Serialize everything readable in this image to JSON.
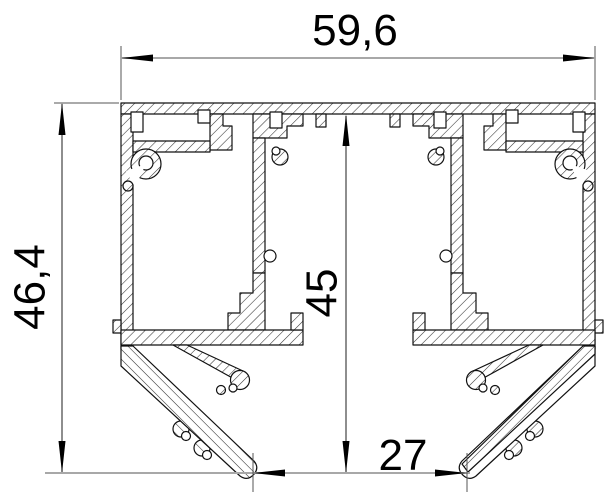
{
  "drawing": {
    "kind": "aluminium-profile-cross-section",
    "units_decimal_separator": ","
  },
  "dimensions": {
    "overall_width": {
      "label": "59,6",
      "orientation": "horizontal",
      "position": "top"
    },
    "overall_height": {
      "label": "46,4",
      "orientation": "vertical",
      "position": "left"
    },
    "inner_height": {
      "label": "45",
      "orientation": "vertical",
      "position": "center"
    },
    "bottom_width": {
      "label": "27",
      "orientation": "horizontal",
      "position": "bottom"
    }
  },
  "colors": {
    "background": "#ffffff",
    "outline": "#111111",
    "hatch": "#333333",
    "dimension_line_light": "#a8a8a8",
    "dimension_line_dark": "#444444",
    "arrow": "#000000",
    "text": "#000000"
  }
}
